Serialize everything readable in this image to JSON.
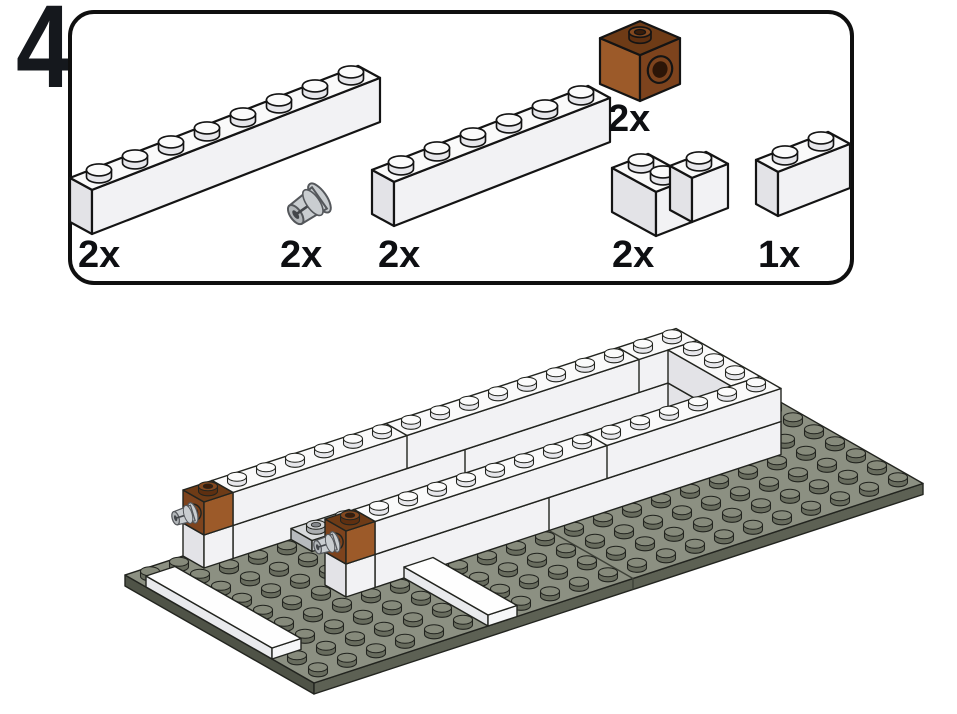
{
  "page": {
    "background": "#ffffff"
  },
  "step": {
    "number": "4"
  },
  "parts_panel": {
    "parts": [
      {
        "id": "brick-1x8-white",
        "label": "2x"
      },
      {
        "id": "pin-technic-gray",
        "label": "2x"
      },
      {
        "id": "brick-1x6-white",
        "label": "2x"
      },
      {
        "id": "brick-1x1-technic-brown",
        "label": "2x"
      },
      {
        "id": "brick-2x2-corner-white",
        "label": "2x"
      },
      {
        "id": "brick-1x2-white",
        "label": "1x"
      }
    ]
  },
  "scene": {
    "colors": {
      "white": {
        "top": "#fafafa",
        "left": "#e3e3e7",
        "front": "#f2f2f4",
        "stud_top": "#fbfbfb",
        "stud_side": "#e7e7eb"
      },
      "tile": {
        "top": "#fefefe",
        "left": "#e9eaed",
        "front": "#f5f6f7",
        "stud_top": "#ffffff",
        "stud_side": "#ececef"
      },
      "grayplate": {
        "top": "#d8dadc",
        "left": "#b7babd",
        "front": "#c9cbce",
        "stud_top": "#d2d4d6",
        "stud_side": "#aaadb0",
        "stud_in": "#85888c"
      },
      "brown_p": {
        "top": "#6e3b16",
        "left": "#9c5a29",
        "front": "#7d431d",
        "stud_top": "#83481f",
        "stud_side": "#5e2f10",
        "stud_in": "#3a1c09"
      },
      "brown_a": {
        "top": "#6e3b16",
        "left": "#7d431d",
        "front": "#9c5a29",
        "stud_top": "#83481f",
        "stud_side": "#5e2f10",
        "stud_in": "#3a1c09"
      },
      "base": {
        "top": "#8c9082",
        "left": "#4f5347",
        "front": "#5d6154",
        "stud_top": "#868a7b",
        "stud_side": "#686c5e",
        "seam": "#3e4138"
      },
      "pin": {
        "body": "#c9cdd0",
        "tip": "#b2b6b9",
        "dark": "#43464a",
        "line": "#54575b"
      },
      "hole": {
        "ring": "#7d431d",
        "inner": "#2c1507"
      }
    },
    "cfgs": {
      "a": {
        "u": [
          29,
          -9.5
        ],
        "v": [
          21,
          12
        ],
        "plate": 11,
        "stud": {
          "rx": 9.5,
          "ry": 4.5,
          "h": 5
        },
        "sw": 1.4,
        "line": "#22241f",
        "hole": [
          7.5,
          8.5
        ],
        "holeRot": -18,
        "pin": {
          "scale": 0.62,
          "rot": -17,
          "off": [
            -9,
            3
          ]
        }
      },
      "p": {
        "u": [
          36,
          -14
        ],
        "v": [
          22,
          12
        ],
        "plate": 14.7,
        "stud": {
          "rx": 12.5,
          "ry": 6,
          "h": 7
        },
        "sw": 2.2,
        "line": "#141414"
      },
      "pb": {
        "u": [
          40,
          -17
        ],
        "v": [
          40,
          17
        ],
        "plate": 15.3,
        "stud": {
          "rx": 11,
          "ry": 5.2,
          "h": 6
        },
        "sw": 2.2,
        "line": "#141414",
        "hole": [
          12,
          13.5
        ],
        "holeRot": 20
      }
    },
    "items": [
      {
        "cfg": "p",
        "origin": [
          70,
          222
        ],
        "pieces": [
          {
            "type": "box",
            "grid": [
              0,
              0,
              8,
              1
            ],
            "z": 0,
            "h": 3,
            "color": "white",
            "studs": true
          }
        ]
      },
      {
        "cfg": "p",
        "origin": [
          372,
          214
        ],
        "pieces": [
          {
            "type": "box",
            "grid": [
              0,
              0,
              6,
              1
            ],
            "z": 0,
            "h": 3,
            "color": "white",
            "studs": true
          }
        ]
      },
      {
        "cfg": "pb",
        "origin": [
          600,
          84
        ],
        "pieces": [
          {
            "type": "technic",
            "grid": [
              0,
              0,
              1,
              1
            ],
            "z": 0,
            "h": 3,
            "color": "brown_p",
            "hole": "front"
          }
        ]
      },
      {
        "cfg": "p",
        "origin": [
          612,
          212
        ],
        "pieces": [
          {
            "type": "box",
            "grid": [
              0,
              0,
              1,
              2
            ],
            "z": 0,
            "h": 3,
            "color": "white",
            "studs": true
          },
          {
            "type": "box",
            "grid": [
              1,
              1,
              1,
              1
            ],
            "z": 0,
            "h": 3,
            "color": "white",
            "studs": true
          }
        ]
      },
      {
        "cfg": "p",
        "origin": [
          756,
          204
        ],
        "pieces": [
          {
            "type": "box",
            "grid": [
              0,
              0,
              2,
              1
            ],
            "z": 0,
            "h": 3,
            "color": "white",
            "studs": true
          }
        ]
      },
      {
        "cfg": "p",
        "origin": [
          0,
          0
        ],
        "pieces": [
          {
            "type": "pin",
            "at": [
              308,
              206
            ],
            "rot": -35,
            "scale": 1
          }
        ]
      },
      {
        "cfg": "a",
        "origin": [
          125,
          575
        ],
        "pieces": [
          {
            "type": "box",
            "grid": [
              0,
              0,
              21,
              9
            ],
            "z": -1,
            "h": 1,
            "color": "base",
            "baseStuds": true,
            "seams": [
              11
            ],
            "seamTop": true
          },
          {
            "type": "box",
            "grid": [
              3,
              0,
              16,
              1
            ],
            "z": 0,
            "h": 3,
            "color": "white",
            "seams": [
              8
            ],
            "covers": true
          },
          {
            "type": "box",
            "grid": [
              3,
              0,
              16,
              1
            ],
            "z": 3,
            "h": 3,
            "color": "white",
            "studs": true,
            "seams": [
              6,
              14
            ]
          },
          {
            "type": "box",
            "grid": [
              2,
              0,
              1,
              1
            ],
            "z": 0,
            "h": 3,
            "color": "white",
            "covers": true
          },
          {
            "type": "technic",
            "grid": [
              2,
              0,
              1,
              1
            ],
            "z": 3,
            "h": 3,
            "color": "brown_a",
            "hole": "left",
            "pin": true
          },
          {
            "type": "box",
            "grid": [
              18,
              1,
              1,
              3
            ],
            "z": 0,
            "h": 3,
            "color": "white",
            "covers": true
          },
          {
            "type": "box",
            "grid": [
              18,
              1,
              1,
              3
            ],
            "z": 3,
            "h": 3,
            "color": "white",
            "studs": true
          },
          {
            "type": "box",
            "grid": [
              5,
              1,
              2,
              1
            ],
            "z": 0,
            "h": 1,
            "color": "grayplate",
            "studs": true,
            "hollow": true,
            "covers": true
          },
          {
            "type": "box",
            "grid": [
              6,
              2,
              2,
              1
            ],
            "z": 0,
            "h": 1,
            "color": "grayplate",
            "studs": true,
            "hollow": true,
            "covers": true
          },
          {
            "type": "box",
            "grid": [
              7,
              3,
              2,
              1
            ],
            "z": 0,
            "h": 1,
            "color": "grayplate",
            "studs": true,
            "hollow": true,
            "covers": true
          },
          {
            "type": "box",
            "grid": [
              5,
              4,
              14,
              1
            ],
            "z": 0,
            "h": 3,
            "color": "white",
            "seams": [
              6
            ],
            "covers": true
          },
          {
            "type": "box",
            "grid": [
              5,
              4,
              14,
              1
            ],
            "z": 3,
            "h": 3,
            "color": "white",
            "studs": true,
            "seams": [
              8
            ]
          },
          {
            "type": "box",
            "grid": [
              4,
              4,
              1,
              1
            ],
            "z": 0,
            "h": 3,
            "color": "white",
            "covers": true
          },
          {
            "type": "technic",
            "grid": [
              4,
              4,
              1,
              1
            ],
            "z": 3,
            "h": 3,
            "color": "brown_a",
            "hole": "left",
            "pin": true
          },
          {
            "type": "box",
            "grid": [
              0,
              1,
              1,
              6
            ],
            "z": 0,
            "h": 1,
            "color": "tile",
            "covers": true
          },
          {
            "type": "box",
            "grid": [
              6,
              5,
              1,
              4
            ],
            "z": 0,
            "h": 1,
            "color": "tile",
            "covers": true
          }
        ]
      }
    ]
  }
}
